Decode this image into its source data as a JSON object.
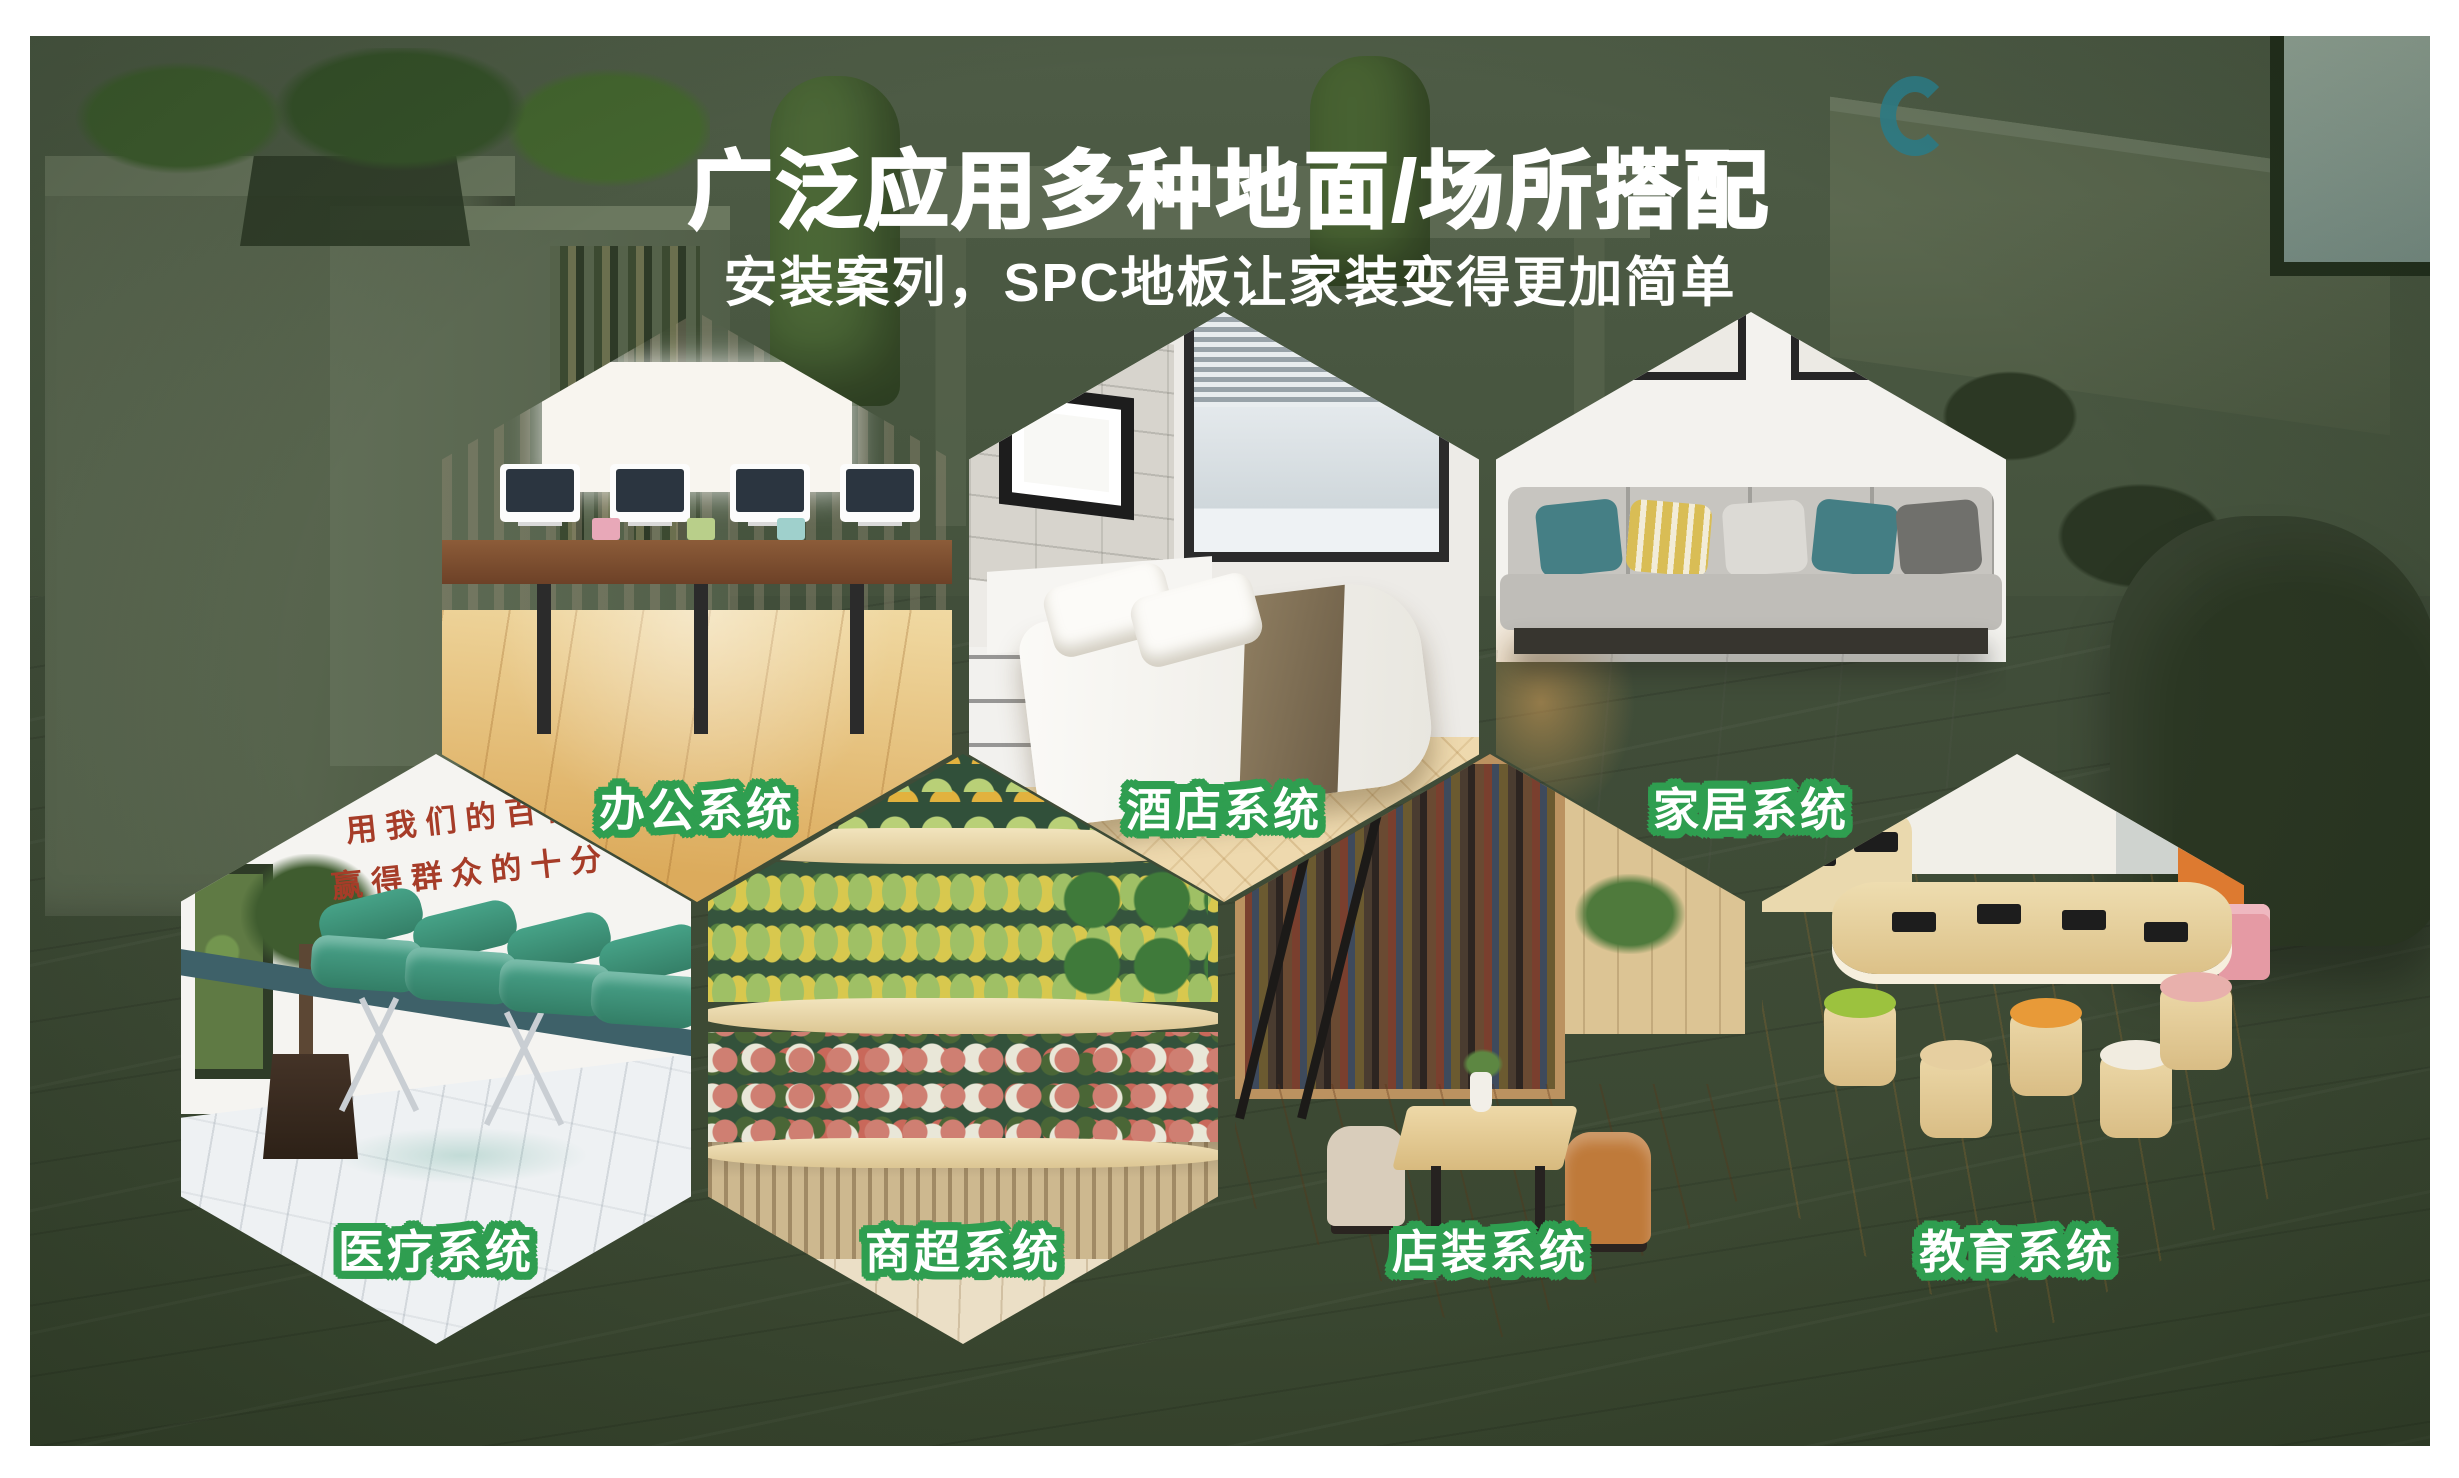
{
  "page": {
    "title": "广泛应用多种地面/场所搭配",
    "subtitle": "安装案列，SPC地板让家装变得更加简单"
  },
  "colors": {
    "page_margin_white": "#ffffff",
    "background_green": "#43513c",
    "label_outline_green": "#2f9e50",
    "heading_white": "#ffffff",
    "medical_slogan_red": "#a63c28"
  },
  "hexagons": [
    {
      "id": "office",
      "label": "办公系统"
    },
    {
      "id": "hotel",
      "label": "酒店系统"
    },
    {
      "id": "home",
      "label": "家居系统"
    },
    {
      "id": "medical",
      "label": "医疗系统",
      "wall_slogan_line1": "用我们的百倍",
      "wall_slogan_line2": "赢得群众的十分满"
    },
    {
      "id": "market",
      "label": "商超系统"
    },
    {
      "id": "shop",
      "label": "店装系统"
    },
    {
      "id": "education",
      "label": "教育系统"
    }
  ]
}
